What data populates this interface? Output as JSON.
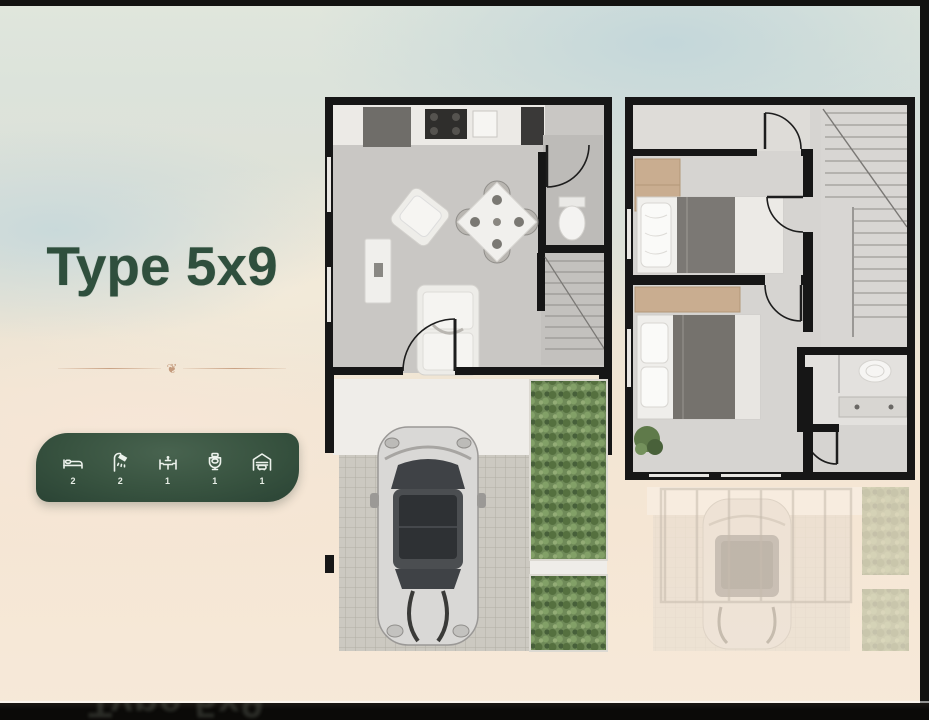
{
  "slide": {
    "title": "Type 5x9",
    "ornament_glyph": "❦",
    "reflection_text": "Type 5x9"
  },
  "amenities": {
    "items": [
      {
        "name": "bedrooms",
        "icon": "bed-icon",
        "count": "2"
      },
      {
        "name": "showers",
        "icon": "shower-icon",
        "count": "2"
      },
      {
        "name": "dining",
        "icon": "dining-table-icon",
        "count": "1"
      },
      {
        "name": "toilets",
        "icon": "toilet-icon",
        "count": "1"
      },
      {
        "name": "garage",
        "icon": "garage-icon",
        "count": "1"
      }
    ]
  },
  "floor_plans": {
    "ground_floor": {
      "name": "ground-floor-plan",
      "features": [
        "kitchen",
        "living-room",
        "dining-area",
        "wc",
        "staircase",
        "entrance-door",
        "tiled-driveway",
        "car",
        "garden-strips"
      ]
    },
    "upper_floor": {
      "name": "upper-floor-plan",
      "features": [
        "bedroom-single-bed",
        "bedroom-double-bed",
        "wardrobe",
        "bathroom",
        "staircase",
        "ghosted-carport-below",
        "pergola"
      ]
    }
  },
  "colors": {
    "title_green": "#2f4f3d",
    "bar_green_dark": "#203830",
    "bar_green_light": "#45614f",
    "ornament_tan": "#c49b7d",
    "wall_black": "#161616",
    "floor_grey": "#c9c7c4",
    "garden_green": "#6f8a58",
    "background_beige": "#f4e6d5",
    "background_blue": "#c6d7da",
    "bottom_band_black": "#0b0a08"
  }
}
